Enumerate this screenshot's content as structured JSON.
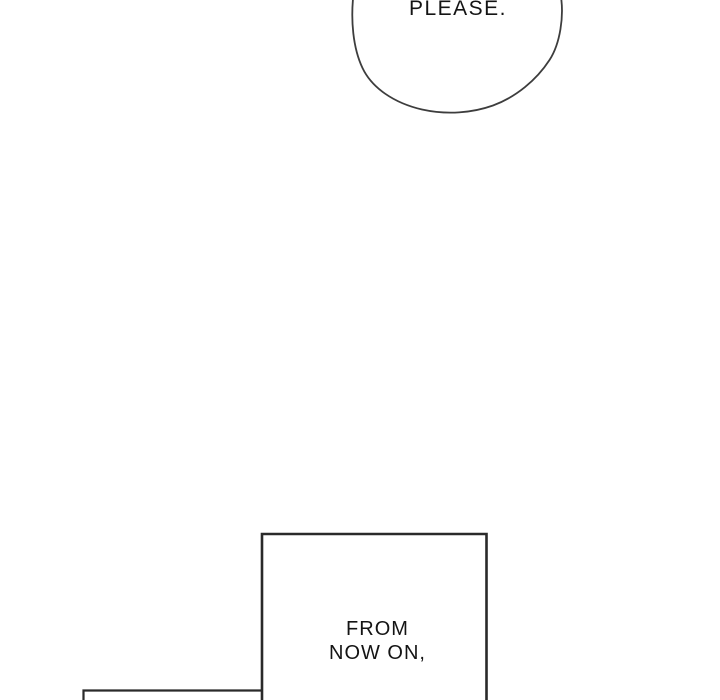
{
  "speech_bubble": {
    "text": "PLEASE."
  },
  "dialog_panel": {
    "lines": [
      "FROM",
      "NOW ON,"
    ]
  },
  "colors": {
    "background": "#ffffff",
    "bubble_outline": "#3d3d3d",
    "panel_border": "#2a2a2a",
    "text": "#141414"
  }
}
